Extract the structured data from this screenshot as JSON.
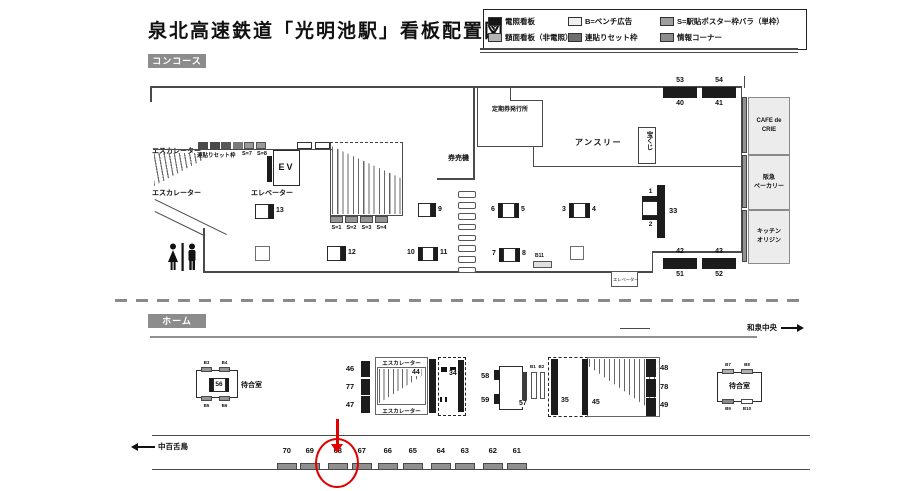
{
  "title": "泉北高速鉄道「光明池駅」看板配置図",
  "legend": {
    "items": [
      {
        "label": "電照看板",
        "color": "#161616"
      },
      {
        "label": "B=ベンチ広告",
        "color": "#f0f0f0"
      },
      {
        "label": "S=駅貼ポスター枠バラ（単枠）",
        "color": "#9e9e9e"
      },
      {
        "label": "額面看板（非電照）",
        "color": "#b5b5b5"
      },
      {
        "label": "連貼りセット枠",
        "color": "#6e6e6e"
      },
      {
        "label": "情報コーナー",
        "color": "#8c8c8c"
      }
    ]
  },
  "concourse": {
    "section_label": "コンコース",
    "escalator_upper": "エスカレーター",
    "escalator_lower": "エスカレーター",
    "renbari_label": "連貼りセット枠",
    "s7": "S=7",
    "s8": "S=8",
    "ev": "EV",
    "elevator": "エレベーター",
    "elevator_small": "エレベーター",
    "ticket_office": "定期券発行所",
    "ticket_machines": "券売機",
    "shop_anthree": "アンスリー",
    "lottery": "宝くじ",
    "stair_posters": [
      "S=1",
      "S=2",
      "S=3",
      "S=4"
    ],
    "signs": {
      "n13": "13",
      "n12": "12",
      "n9": "9",
      "n10": "10",
      "n11": "11",
      "n6": "6",
      "n5": "5",
      "n3": "3",
      "n4": "4",
      "n7": "7",
      "n8": "8",
      "n1": "1",
      "n2": "2",
      "n33": "33",
      "b11": "B11"
    },
    "wall_top": [
      {
        "upper": "53",
        "lower": "40"
      },
      {
        "upper": "54",
        "lower": "41"
      }
    ],
    "wall_bottom": [
      {
        "upper": "42",
        "lower": "51"
      },
      {
        "upper": "43",
        "lower": "52"
      }
    ],
    "shops": [
      "CAFE de\nCRIE",
      "阪急\nベーカリー",
      "キッチン\nオリジン"
    ]
  },
  "platform": {
    "section_label": "ホーム",
    "direction_right": "和泉中央",
    "direction_left": "中百舌鳥",
    "waiting_left": {
      "label": "待合室",
      "sign": "56",
      "b_top": [
        "B3",
        "B4"
      ],
      "b_bottom": [
        "B5",
        "B6"
      ]
    },
    "waiting_right": {
      "label": "待合室",
      "b_top": [
        "B7",
        "B8"
      ],
      "b_bottom": [
        "B9",
        "B10"
      ]
    },
    "esc": {
      "top": "エスカレーター",
      "bottom": "エスカレーター",
      "n44": "44",
      "n34": "34",
      "n46": "46",
      "n77": "77",
      "n47": "47"
    },
    "kiosk": {
      "n58": "58",
      "n59": "59",
      "n57": "57",
      "b1": "B1",
      "b2": "B2"
    },
    "stairs": {
      "n35": "35",
      "n45": "45",
      "n48": "48",
      "n78": "78",
      "n49": "49"
    },
    "bottom_signs": [
      "70",
      "69",
      "68",
      "67",
      "66",
      "65",
      "64",
      "63",
      "62",
      "61"
    ]
  }
}
